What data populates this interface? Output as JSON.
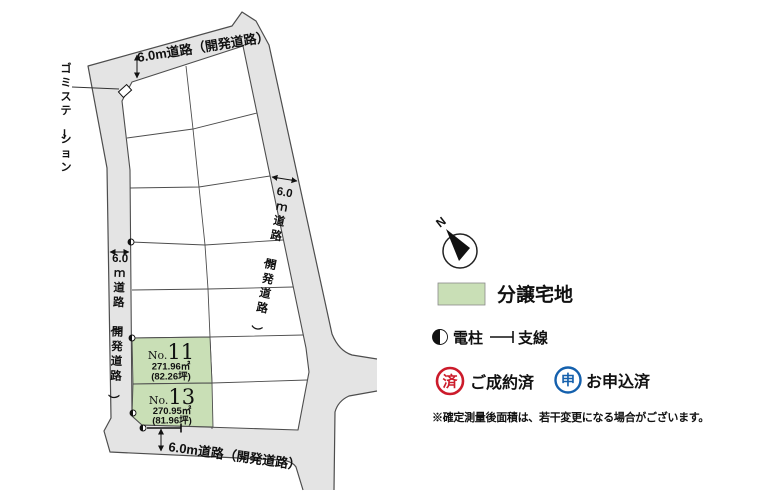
{
  "map": {
    "roads": {
      "top": {
        "label": "6.0m道路（開発道路）"
      },
      "bottom": {
        "label": "6.0m道路（開発道路）"
      },
      "left": {
        "label": "6.0ｍ道路（開発道路）"
      },
      "right": {
        "label": "6.0ｍ道路（開発道路）"
      }
    },
    "garbage_station_label": "ゴミステーション",
    "plots": [
      {
        "label_prefix": "No.",
        "label_number": "11",
        "area_m2": "271.96㎡",
        "area_tsubo": "(82.26坪)",
        "status": "for-sale"
      },
      {
        "label_prefix": "No.",
        "label_number": "13",
        "area_m2": "270.95㎡",
        "area_tsubo": "(81.96坪)",
        "status": "for-sale"
      }
    ]
  },
  "legend": {
    "compass_n": "N",
    "lot_label": "分譲宅地",
    "pole_label": "電柱",
    "wire_label": "支線",
    "sold_stamp": "済",
    "sold_label": "ご成約済",
    "applied_stamp": "申",
    "applied_label": "お申込済"
  },
  "note": "※確定測量後面積は、若干変更になる場合がございます。",
  "colors": {
    "lot_green": "#c9dfb6",
    "road_gray": "#e4e4e4",
    "line": "#4d4d4d",
    "stamp_red": "#cc1b2b",
    "stamp_blue": "#1460ad"
  }
}
